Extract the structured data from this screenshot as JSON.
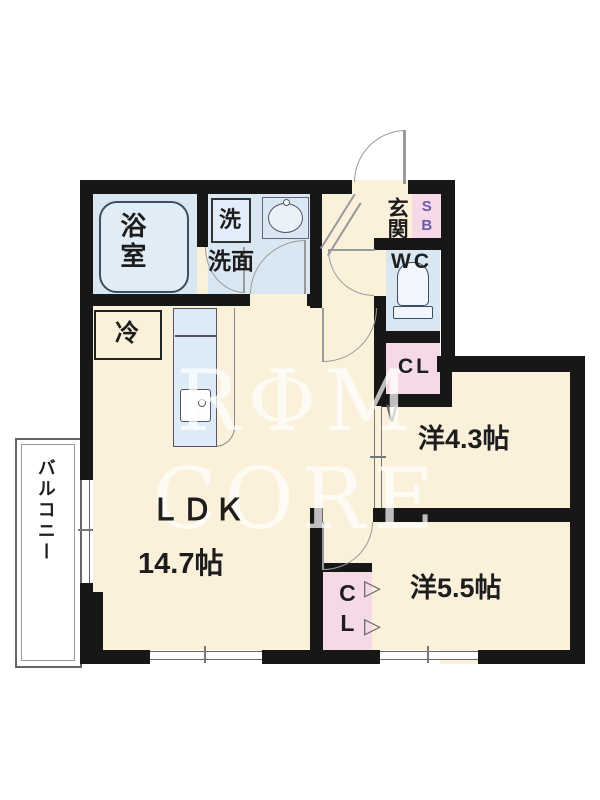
{
  "title": "1LDK+2R apartment floor plan",
  "watermark": {
    "text": "RΦM CORE"
  },
  "labels": {
    "bathroom": "浴室",
    "washer": "洗",
    "washroom": "洗面",
    "entrance": "玄関",
    "shoe_box": "SB",
    "wc": "WC",
    "closet_upper": "CL",
    "closet_lower": "CL",
    "refrigerator": "冷",
    "ldk_name": "ＬＤＫ",
    "ldk_size": "14.7帖",
    "western_room_small": "洋4.3帖",
    "western_room_large": "洋5.5帖",
    "balcony": "バルコニー",
    "bifold_mark": "▷",
    "closet_door_mark": "∨"
  },
  "colors": {
    "wall": "#171717",
    "room_cream": "#fbf0da",
    "wet_area_blue": "#d9e7f3",
    "storage_pink": "#f6d9e6",
    "shoebox_letters": "#6b5ca8",
    "thin_line": "#777777",
    "watermark": "rgba(255,255,255,0.72)"
  }
}
